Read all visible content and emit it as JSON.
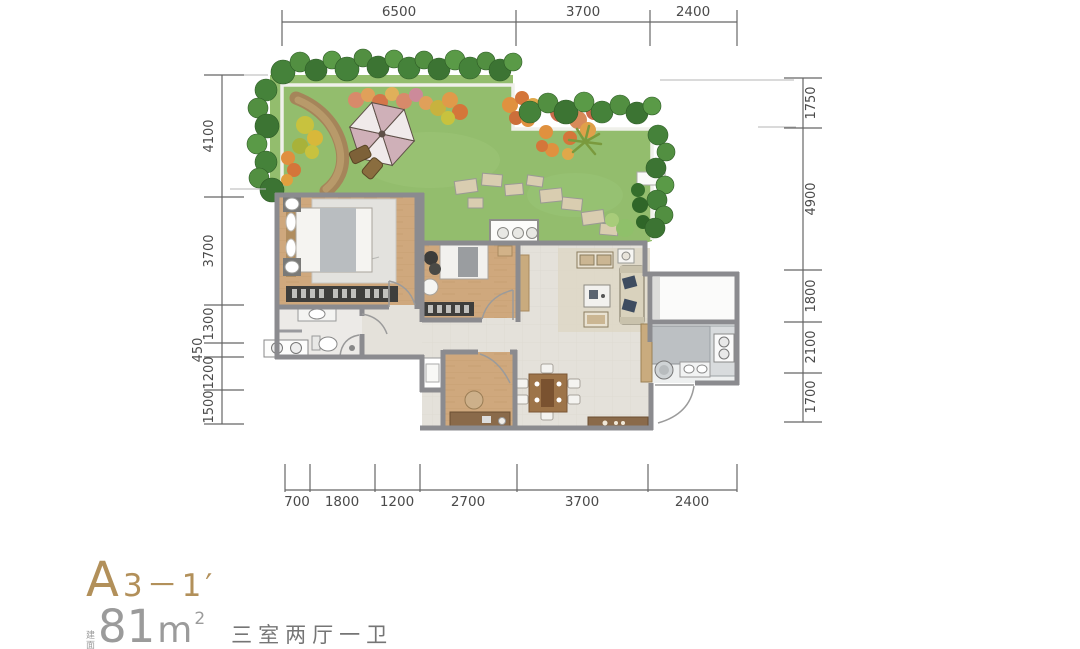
{
  "title": {
    "unit_code_prefix": "A",
    "unit_code_suffix": "3－1′",
    "area_label_small": "建面约",
    "area_number": "81",
    "area_unit": "m",
    "area_exponent": "2",
    "rooms_text": "三室两厅一卫"
  },
  "dims": {
    "top": [
      "6500",
      "3700",
      "2400"
    ],
    "bottom": [
      "700",
      "1800",
      "1200",
      "2700",
      "3700",
      "2400"
    ],
    "left": [
      "4100",
      "3700",
      "1300",
      "450",
      "1200",
      "1500"
    ],
    "right": [
      "1750",
      "4900",
      "1800",
      "2100",
      "1700"
    ]
  },
  "colors": {
    "accent_gold": "#b2905a",
    "area_text_gray": "#9b9b9b",
    "rooms_text_gray": "#757575",
    "dimension_text": "#4a4a4a",
    "wall_gray": "#8b8b8f",
    "grass_green": "#93bd6d",
    "wood_floor": "#cfa87d",
    "tile_floor": "#e4e1da",
    "umbrella_pink": "#cfb0b8",
    "counter_gray": "#bcc0c3"
  }
}
